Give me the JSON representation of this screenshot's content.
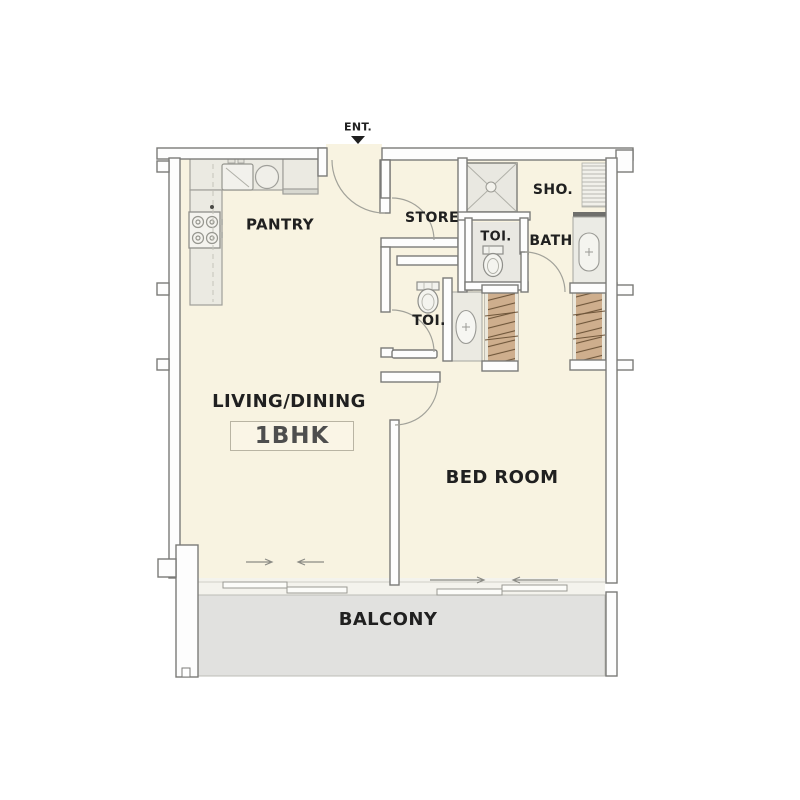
{
  "plan": {
    "entrance_label": "ENT.",
    "unit_type": "1BHK",
    "rooms": {
      "pantry": "PANTRY",
      "store": "STORE",
      "shower": "SHO.",
      "toilet_upper": "TOI.",
      "bath": "BATH",
      "toilet_mid": "TOI.",
      "living_dining": "LIVING/DINING",
      "bedroom": "BED ROOM",
      "balcony": "BALCONY"
    },
    "colors": {
      "floor_cream": "#f8f3e1",
      "wall_fill": "#fdfdfd",
      "wall_outline": "#7b7b78",
      "balcony_gray": "#e1e1df",
      "wardrobe_wood": "#ceae8d",
      "fixture_gray": "#ebeae2",
      "text": "#202020"
    }
  }
}
